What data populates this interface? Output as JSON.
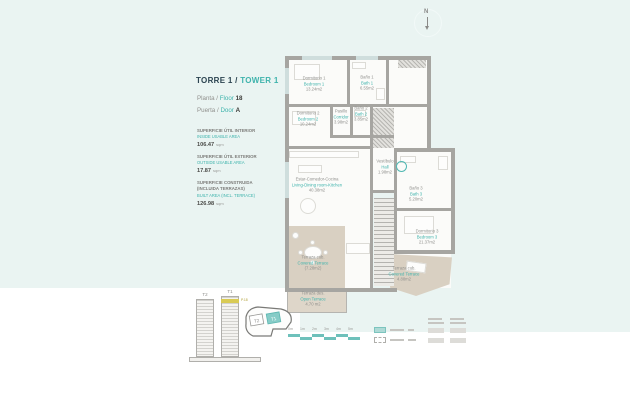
{
  "title": {
    "torre": "TORRE 1 /",
    "tower": "TOWER 1",
    "planta_es": "Planta",
    "slash": "/",
    "planta_en": "Floor",
    "planta_num": "18",
    "puerta_es": "Puerta",
    "puerta_en": "Door",
    "puerta_letter": "A"
  },
  "surfaces": [
    {
      "es": "SUPERFICIE ÚTIL INTERIOR",
      "en": "INSIDE USABLE AREA",
      "value": "106.47",
      "unit": "sqm"
    },
    {
      "es": "SUPERFICIE ÚTIL EXTERIOR",
      "en": "OUTSIDE USABLE AREA",
      "value": "17.87",
      "unit": "sqm"
    },
    {
      "es": "SUPERFICIE CONSTRUIDA (INCLUIDA TERRAZAS)",
      "en": "BUILT AREA (INCL. TERRACE)",
      "value": "126.98",
      "unit": "sqm"
    }
  ],
  "rooms": [
    {
      "es": "Dormitorio 1",
      "en": "Bedroom 1",
      "area": "13.24m2"
    },
    {
      "es": "Baño 1",
      "en": "Bath 1",
      "area": "6.55m2"
    },
    {
      "es": "Dormitorio 2",
      "en": "Bedroom 2",
      "area": "10.24m2"
    },
    {
      "es": "Pasillo",
      "en": "Corridor",
      "area": "3.98m2"
    },
    {
      "es": "Baño 2",
      "en": "Bath 2",
      "area": "3.85m2"
    },
    {
      "es": "Estar-Comedor-Cocina",
      "en": "Living-Dining room-Kitchen",
      "area": "40.38m2"
    },
    {
      "es": "Vestíbulo",
      "en": "Hall",
      "area": "1.98m2"
    },
    {
      "es": "Baño 3",
      "en": "Bath 3",
      "area": "5.20m2"
    },
    {
      "es": "Dormitorio 3",
      "en": "Bedroom 3",
      "area": "21.37m2"
    },
    {
      "es": "Terraza cub.",
      "en": "Covered Terrace",
      "area": "(7.28m2)"
    },
    {
      "es": "Terraza des.",
      "en": "Open Terrace",
      "area": "4.70 m2"
    },
    {
      "es": "Terraza cub.",
      "en": "Covered Terrace",
      "area": "4.88m2"
    }
  ],
  "compass": {
    "label": "N"
  },
  "towers": {
    "t2_label": "T2",
    "t1_label": "T1",
    "floor_mark": "P.18"
  },
  "site_plan": {
    "t2_label": "T2",
    "t1_label": "T1"
  },
  "scale_bar": {
    "ticks": [
      "0m",
      "1m",
      "2m",
      "3m",
      "4m",
      "5m"
    ]
  },
  "colors": {
    "accent_teal": "#3eb3ac",
    "title_navy": "#2b4350",
    "terrace_beige": "#d9d0c2",
    "wall_gray": "#a6a5a1",
    "highlight_yellow": "#d9cb55",
    "background_blue": "#eaf4f2"
  }
}
